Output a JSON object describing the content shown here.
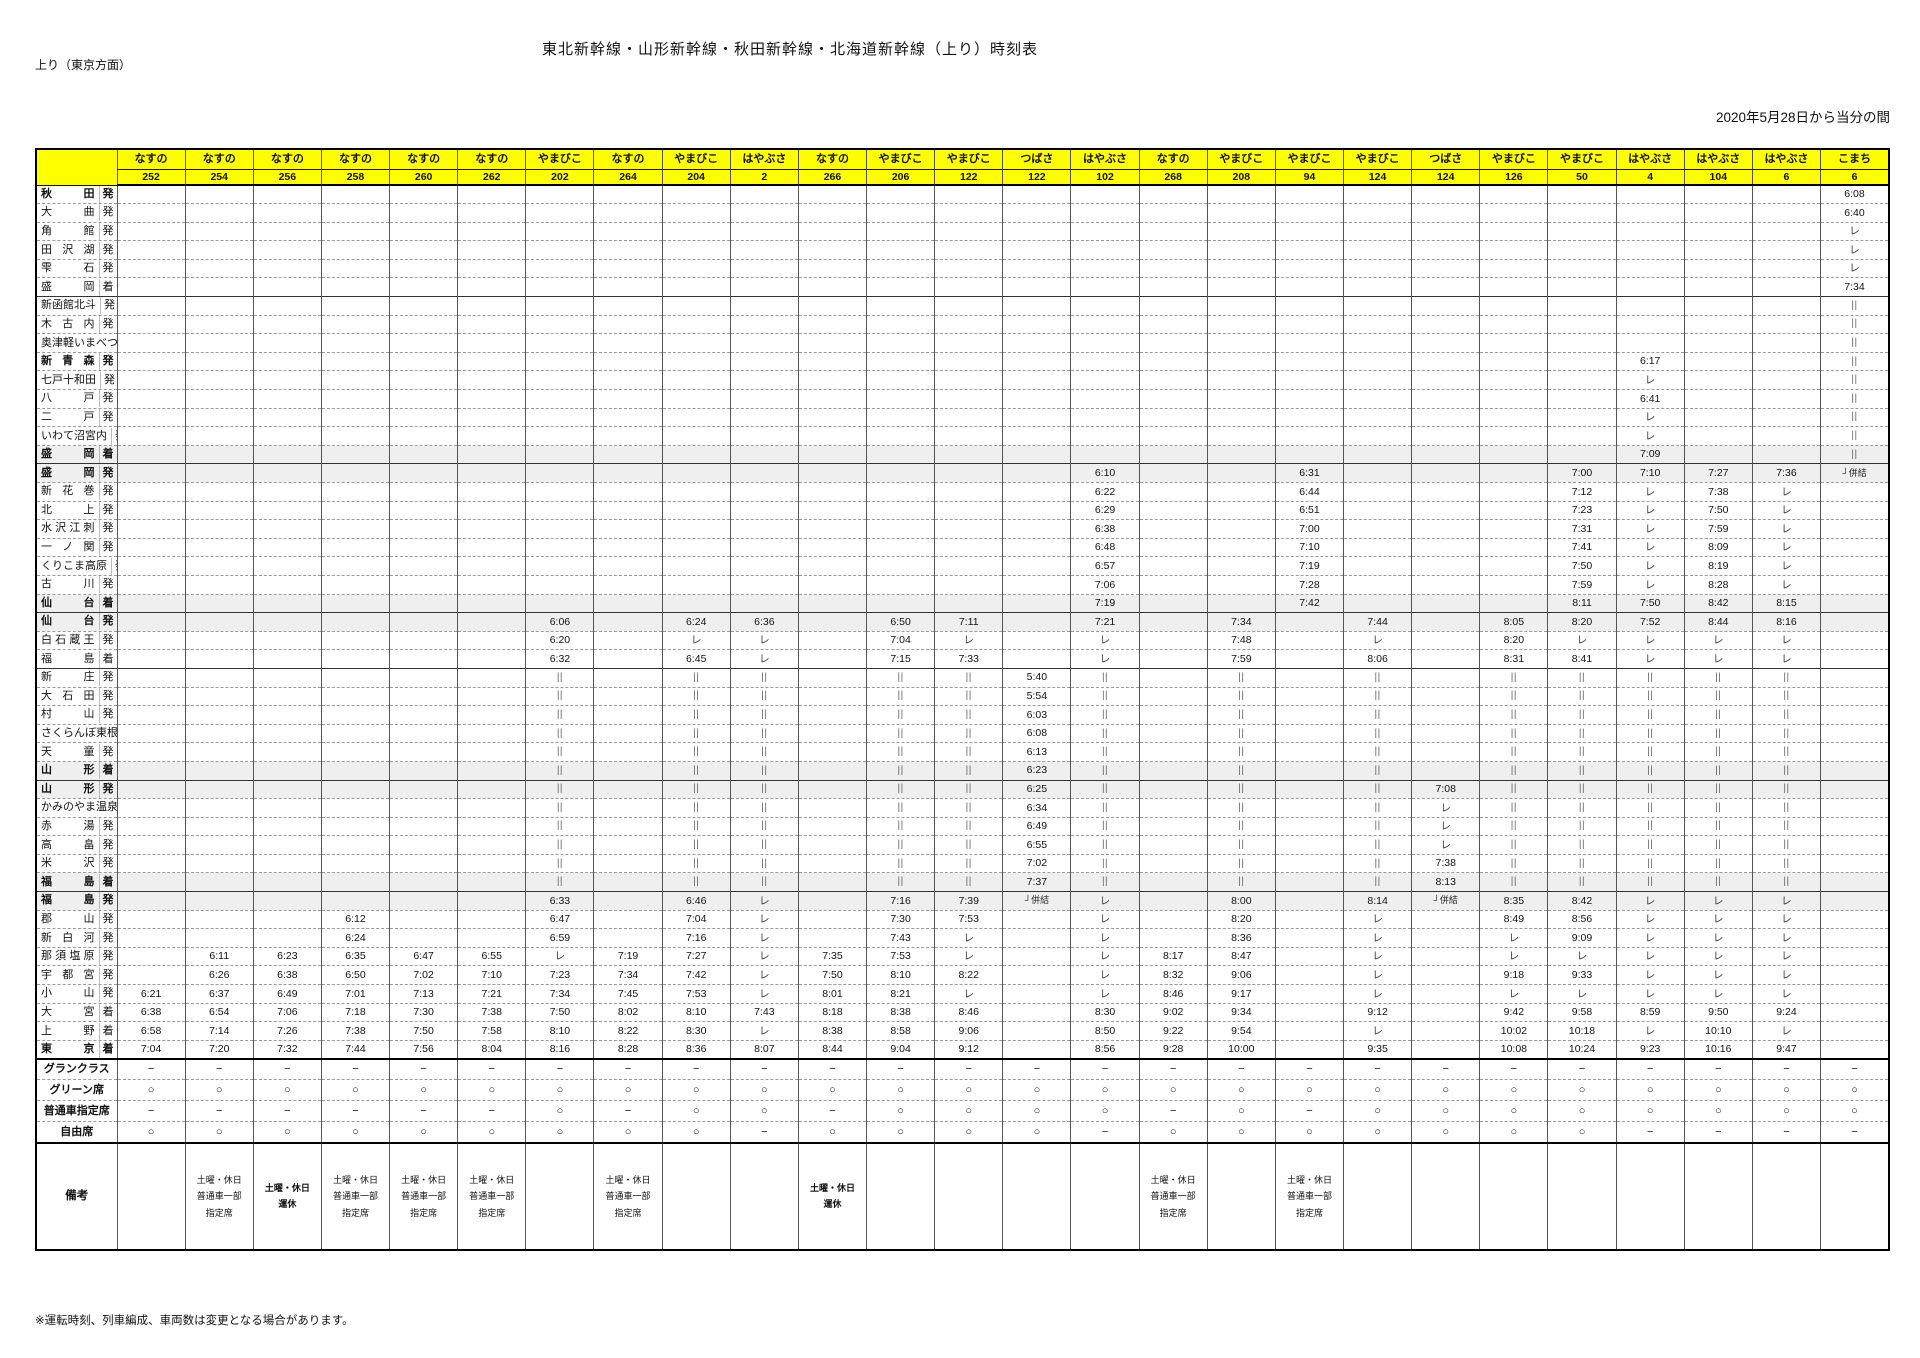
{
  "page": {
    "title": "東北新幹線・山形新幹線・秋田新幹線・北海道新幹線（上り）時刻表",
    "direction_label": "上り（東京方面）",
    "effective_note": "2020年5月28日から当分の間",
    "footnote": "※運転時刻、列車編成、車両数は変更となる場合があります。",
    "remarks_label": "備考",
    "header_color": "#ffff00"
  },
  "legend": {
    "pass": "レ",
    "other_line": "||",
    "couple": "┘併結",
    "yes": "○",
    "no": "−"
  },
  "seat_rows": [
    {
      "key": "gran",
      "label": "グランクラス"
    },
    {
      "key": "green",
      "label": "グリーン席"
    },
    {
      "key": "reserved",
      "label": "普通車指定席"
    },
    {
      "key": "free",
      "label": "自由席"
    }
  ],
  "stations": [
    {
      "n": "秋田",
      "s": "発",
      "b": 1
    },
    {
      "n": "大曲",
      "s": "発"
    },
    {
      "n": "角館",
      "s": "発"
    },
    {
      "n": "田沢湖",
      "s": "発"
    },
    {
      "n": "雫石",
      "s": "発"
    },
    {
      "n": "盛岡",
      "s": "着"
    },
    {
      "n": "新函館北斗",
      "s": "発",
      "t": 1
    },
    {
      "n": "木古内",
      "s": "発"
    },
    {
      "n": "奥津軽いまべつ",
      "s": "発"
    },
    {
      "n": "新青森",
      "s": "発",
      "b": 1
    },
    {
      "n": "七戸十和田",
      "s": "発"
    },
    {
      "n": "八戸",
      "s": "発"
    },
    {
      "n": "二戸",
      "s": "発"
    },
    {
      "n": "いわて沼宮内",
      "s": "発"
    },
    {
      "n": "盛岡",
      "s": "着",
      "b": 1,
      "g": 1
    },
    {
      "n": "盛岡",
      "s": "発",
      "b": 1,
      "g": 1,
      "t": 1
    },
    {
      "n": "新花巻",
      "s": "発"
    },
    {
      "n": "北上",
      "s": "発"
    },
    {
      "n": "水沢江刺",
      "s": "発"
    },
    {
      "n": "一ノ関",
      "s": "発"
    },
    {
      "n": "くりこま高原",
      "s": "発"
    },
    {
      "n": "古川",
      "s": "発"
    },
    {
      "n": "仙台",
      "s": "着",
      "b": 1,
      "g": 1
    },
    {
      "n": "仙台",
      "s": "発",
      "b": 1,
      "g": 1,
      "t": 1
    },
    {
      "n": "白石蔵王",
      "s": "発"
    },
    {
      "n": "福島",
      "s": "着"
    },
    {
      "n": "新庄",
      "s": "発",
      "t": 1
    },
    {
      "n": "大石田",
      "s": "発"
    },
    {
      "n": "村山",
      "s": "発"
    },
    {
      "n": "さくらんぼ東根",
      "s": "発"
    },
    {
      "n": "天童",
      "s": "発"
    },
    {
      "n": "山形",
      "s": "着",
      "b": 1,
      "g": 1
    },
    {
      "n": "山形",
      "s": "発",
      "b": 1,
      "g": 1,
      "t": 1
    },
    {
      "n": "かみのやま温泉",
      "s": "発"
    },
    {
      "n": "赤湯",
      "s": "発"
    },
    {
      "n": "高畠",
      "s": "発"
    },
    {
      "n": "米沢",
      "s": "発"
    },
    {
      "n": "福島",
      "s": "着",
      "b": 1,
      "g": 1
    },
    {
      "n": "福島",
      "s": "発",
      "b": 1,
      "g": 1,
      "t": 1
    },
    {
      "n": "郡山",
      "s": "発"
    },
    {
      "n": "新白河",
      "s": "発"
    },
    {
      "n": "那須塩原",
      "s": "発"
    },
    {
      "n": "宇都宮",
      "s": "発"
    },
    {
      "n": "小山",
      "s": "発"
    },
    {
      "n": "大宮",
      "s": "着"
    },
    {
      "n": "上野",
      "s": "着"
    },
    {
      "n": "東京",
      "s": "着",
      "b": 1
    }
  ],
  "trains": [
    {
      "name": "なすの",
      "number": "252",
      "times": {
        "43": "6:21",
        "44": "6:38",
        "45": "6:58",
        "46": "7:04"
      },
      "gran": "−",
      "green": "○",
      "reserved": "−",
      "free": "○",
      "remark": ""
    },
    {
      "name": "なすの",
      "number": "254",
      "times": {
        "41": "6:11",
        "42": "6:26",
        "43": "6:37",
        "44": "6:54",
        "45": "7:14",
        "46": "7:20"
      },
      "gran": "−",
      "green": "○",
      "reserved": "−",
      "free": "○",
      "remark": "土曜・休日\n普通車一部\n指定席"
    },
    {
      "name": "なすの",
      "number": "256",
      "times": {
        "41": "6:23",
        "42": "6:38",
        "43": "6:49",
        "44": "7:06",
        "45": "7:26",
        "46": "7:32"
      },
      "gran": "−",
      "green": "○",
      "reserved": "−",
      "free": "○",
      "remark": "土曜・休日\n運休",
      "remark_bold": true
    },
    {
      "name": "なすの",
      "number": "258",
      "times": {
        "39": "6:12",
        "40": "6:24",
        "41": "6:35",
        "42": "6:50",
        "43": "7:01",
        "44": "7:18",
        "45": "7:38",
        "46": "7:44"
      },
      "gran": "−",
      "green": "○",
      "reserved": "−",
      "free": "○",
      "remark": "土曜・休日\n普通車一部\n指定席"
    },
    {
      "name": "なすの",
      "number": "260",
      "times": {
        "41": "6:47",
        "42": "7:02",
        "43": "7:13",
        "44": "7:30",
        "45": "7:50",
        "46": "7:56"
      },
      "gran": "−",
      "green": "○",
      "reserved": "−",
      "free": "○",
      "remark": "土曜・休日\n普通車一部\n指定席"
    },
    {
      "name": "なすの",
      "number": "262",
      "times": {
        "41": "6:55",
        "42": "7:10",
        "43": "7:21",
        "44": "7:38",
        "45": "7:58",
        "46": "8:04"
      },
      "gran": "−",
      "green": "○",
      "reserved": "−",
      "free": "○",
      "remark": "土曜・休日\n普通車一部\n指定席"
    },
    {
      "name": "やまびこ",
      "number": "202",
      "times": {
        "23": "6:06",
        "24": "6:20",
        "25": "6:32",
        "38": "6:33",
        "39": "6:47",
        "40": "6:59",
        "41": "レ",
        "42": "7:23",
        "43": "7:34",
        "44": "7:50",
        "45": "8:10",
        "46": "8:16"
      },
      "through": [
        26,
        37
      ],
      "gran": "−",
      "green": "○",
      "reserved": "○",
      "free": "○",
      "remark": ""
    },
    {
      "name": "なすの",
      "number": "264",
      "times": {
        "41": "7:19",
        "42": "7:34",
        "43": "7:45",
        "44": "8:02",
        "45": "8:22",
        "46": "8:28"
      },
      "gran": "−",
      "green": "○",
      "reserved": "−",
      "free": "○",
      "remark": "土曜・休日\n普通車一部\n指定席"
    },
    {
      "name": "やまびこ",
      "number": "204",
      "times": {
        "23": "6:24",
        "24": "レ",
        "25": "6:45",
        "38": "6:46",
        "39": "7:04",
        "40": "7:16",
        "41": "7:27",
        "42": "7:42",
        "43": "7:53",
        "44": "8:10",
        "45": "8:30",
        "46": "8:36"
      },
      "through": [
        26,
        37
      ],
      "gran": "−",
      "green": "○",
      "reserved": "○",
      "free": "○",
      "remark": ""
    },
    {
      "name": "はやぶさ",
      "number": "2",
      "times": {
        "23": "6:36",
        "24": "レ",
        "25": "レ",
        "38": "レ",
        "39": "レ",
        "40": "レ",
        "41": "レ",
        "42": "レ",
        "43": "レ",
        "44": "7:43",
        "45": "レ",
        "46": "8:07"
      },
      "through": [
        26,
        37
      ],
      "gran": "−",
      "green": "○",
      "reserved": "○",
      "free": "−",
      "remark": ""
    },
    {
      "name": "なすの",
      "number": "266",
      "times": {
        "41": "7:35",
        "42": "7:50",
        "43": "8:01",
        "44": "8:18",
        "45": "8:38",
        "46": "8:44"
      },
      "gran": "−",
      "green": "○",
      "reserved": "−",
      "free": "○",
      "remark": "土曜・休日\n運休",
      "remark_bold": true
    },
    {
      "name": "やまびこ",
      "number": "206",
      "times": {
        "23": "6:50",
        "24": "7:04",
        "25": "7:15",
        "38": "7:16",
        "39": "7:30",
        "40": "7:43",
        "41": "7:53",
        "42": "8:10",
        "43": "8:21",
        "44": "8:38",
        "45": "8:58",
        "46": "9:04"
      },
      "through": [
        26,
        37
      ],
      "gran": "−",
      "green": "○",
      "reserved": "○",
      "free": "○",
      "remark": ""
    },
    {
      "name": "やまびこ",
      "number": "122",
      "times": {
        "23": "7:11",
        "24": "レ",
        "25": "7:33",
        "38": "7:39",
        "39": "7:53",
        "40": "レ",
        "41": "レ",
        "42": "8:22",
        "43": "レ",
        "44": "8:46",
        "45": "9:06",
        "46": "9:12"
      },
      "through": [
        26,
        37
      ],
      "gran": "−",
      "green": "○",
      "reserved": "○",
      "free": "○",
      "remark": ""
    },
    {
      "name": "つばさ",
      "number": "122",
      "times": {
        "26": "5:40",
        "27": "5:54",
        "28": "6:03",
        "29": "6:08",
        "30": "6:13",
        "31": "6:23",
        "32": "6:25",
        "33": "6:34",
        "34": "6:49",
        "35": "6:55",
        "36": "7:02",
        "37": "7:37",
        "38": "┘併結"
      },
      "gran": "−",
      "green": "○",
      "reserved": "○",
      "free": "○",
      "remark": ""
    },
    {
      "name": "はやぶさ",
      "number": "102",
      "times": {
        "15": "6:10",
        "16": "6:22",
        "17": "6:29",
        "18": "6:38",
        "19": "6:48",
        "20": "6:57",
        "21": "7:06",
        "22": "7:19",
        "23": "7:21",
        "24": "レ",
        "25": "レ",
        "38": "レ",
        "39": "レ",
        "40": "レ",
        "41": "レ",
        "42": "レ",
        "43": "レ",
        "44": "8:30",
        "45": "8:50",
        "46": "8:56"
      },
      "through": [
        26,
        37
      ],
      "gran": "−",
      "green": "○",
      "reserved": "○",
      "free": "−",
      "remark": ""
    },
    {
      "name": "なすの",
      "number": "268",
      "times": {
        "41": "8:17",
        "42": "8:32",
        "43": "8:46",
        "44": "9:02",
        "45": "9:22",
        "46": "9:28"
      },
      "gran": "−",
      "green": "○",
      "reserved": "−",
      "free": "○",
      "remark": "土曜・休日\n普通車一部\n指定席"
    },
    {
      "name": "やまびこ",
      "number": "208",
      "times": {
        "23": "7:34",
        "24": "7:48",
        "25": "7:59",
        "38": "8:00",
        "39": "8:20",
        "40": "8:36",
        "41": "8:47",
        "42": "9:06",
        "43": "9:17",
        "44": "9:34",
        "45": "9:54",
        "46": "10:00"
      },
      "through": [
        26,
        37
      ],
      "gran": "−",
      "green": "○",
      "reserved": "○",
      "free": "○",
      "remark": ""
    },
    {
      "name": "やまびこ",
      "number": "94",
      "times": {
        "15": "6:31",
        "16": "6:44",
        "17": "6:51",
        "18": "7:00",
        "19": "7:10",
        "20": "7:19",
        "21": "7:28",
        "22": "7:42"
      },
      "gran": "−",
      "green": "○",
      "reserved": "−",
      "free": "○",
      "remark": "土曜・休日\n普通車一部\n指定席"
    },
    {
      "name": "やまびこ",
      "number": "124",
      "times": {
        "23": "7:44",
        "24": "レ",
        "25": "8:06",
        "38": "8:14",
        "39": "レ",
        "40": "レ",
        "41": "レ",
        "42": "レ",
        "43": "レ",
        "44": "9:12",
        "45": "レ",
        "46": "9:35"
      },
      "through": [
        26,
        37
      ],
      "gran": "−",
      "green": "○",
      "reserved": "○",
      "free": "○",
      "remark": ""
    },
    {
      "name": "つばさ",
      "number": "124",
      "times": {
        "32": "7:08",
        "33": "レ",
        "34": "レ",
        "35": "レ",
        "36": "7:38",
        "37": "8:13",
        "38": "┘併結"
      },
      "gran": "−",
      "green": "○",
      "reserved": "○",
      "free": "○",
      "remark": ""
    },
    {
      "name": "やまびこ",
      "number": "126",
      "times": {
        "23": "8:05",
        "24": "8:20",
        "25": "8:31",
        "38": "8:35",
        "39": "8:49",
        "40": "レ",
        "41": "レ",
        "42": "9:18",
        "43": "レ",
        "44": "9:42",
        "45": "10:02",
        "46": "10:08"
      },
      "through": [
        26,
        37
      ],
      "gran": "−",
      "green": "○",
      "reserved": "○",
      "free": "○",
      "remark": ""
    },
    {
      "name": "やまびこ",
      "number": "50",
      "times": {
        "15": "7:00",
        "16": "7:12",
        "17": "7:23",
        "18": "7:31",
        "19": "7:41",
        "20": "7:50",
        "21": "7:59",
        "22": "8:11",
        "23": "8:20",
        "24": "レ",
        "25": "8:41",
        "38": "8:42",
        "39": "8:56",
        "40": "9:09",
        "41": "レ",
        "42": "9:33",
        "43": "レ",
        "44": "9:58",
        "45": "10:18",
        "46": "10:24"
      },
      "through": [
        26,
        37
      ],
      "gran": "−",
      "green": "○",
      "reserved": "○",
      "free": "○",
      "remark": ""
    },
    {
      "name": "はやぶさ",
      "number": "4",
      "times": {
        "9": "6:17",
        "10": "レ",
        "11": "6:41",
        "12": "レ",
        "13": "レ",
        "14": "7:09",
        "15": "7:10",
        "16": "レ",
        "17": "レ",
        "18": "レ",
        "19": "レ",
        "20": "レ",
        "21": "レ",
        "22": "7:50",
        "23": "7:52",
        "24": "レ",
        "25": "レ",
        "38": "レ",
        "39": "レ",
        "40": "レ",
        "41": "レ",
        "42": "レ",
        "43": "レ",
        "44": "8:59",
        "45": "レ",
        "46": "9:23"
      },
      "through": [
        26,
        37
      ],
      "gran": "−",
      "green": "○",
      "reserved": "○",
      "free": "−",
      "remark": ""
    },
    {
      "name": "はやぶさ",
      "number": "104",
      "times": {
        "15": "7:27",
        "16": "7:38",
        "17": "7:50",
        "18": "7:59",
        "19": "8:09",
        "20": "8:19",
        "21": "8:28",
        "22": "8:42",
        "23": "8:44",
        "24": "レ",
        "25": "レ",
        "38": "レ",
        "39": "レ",
        "40": "レ",
        "41": "レ",
        "42": "レ",
        "43": "レ",
        "44": "9:50",
        "45": "10:10",
        "46": "10:16"
      },
      "through": [
        26,
        37
      ],
      "gran": "−",
      "green": "○",
      "reserved": "○",
      "free": "−",
      "remark": ""
    },
    {
      "name": "はやぶさ",
      "number": "6",
      "times": {
        "15": "7:36",
        "16": "レ",
        "17": "レ",
        "18": "レ",
        "19": "レ",
        "20": "レ",
        "21": "レ",
        "22": "8:15",
        "23": "8:16",
        "24": "レ",
        "25": "レ",
        "38": "レ",
        "39": "レ",
        "40": "レ",
        "41": "レ",
        "42": "レ",
        "43": "レ",
        "44": "9:24",
        "45": "レ",
        "46": "9:47"
      },
      "through": [
        26,
        37
      ],
      "gran": "−",
      "green": "○",
      "reserved": "○",
      "free": "−",
      "remark": ""
    },
    {
      "name": "こまち",
      "number": "6",
      "times": {
        "0": "6:08",
        "1": "6:40",
        "2": "レ",
        "3": "レ",
        "4": "レ",
        "5": "7:34",
        "15": "┘併結"
      },
      "through": [
        6,
        14
      ],
      "gran": "−",
      "green": "○",
      "reserved": "○",
      "free": "−",
      "remark": ""
    }
  ]
}
